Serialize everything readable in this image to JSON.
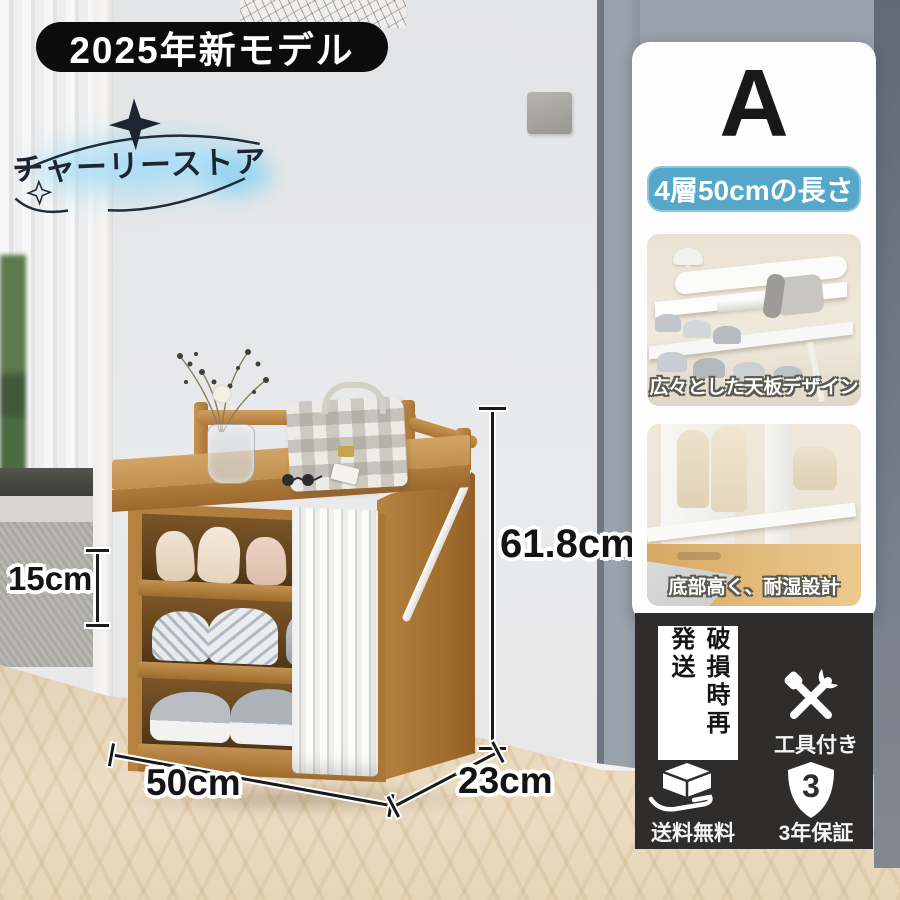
{
  "page": {
    "title_badge": "2025年新モデル",
    "store_name": "チャーリーストア"
  },
  "product": {
    "variant": "A",
    "spec_badge": "4層50cmの長さ"
  },
  "dimensions": {
    "tier_height": "15cm",
    "total_height": "61.8cm",
    "width": "50cm",
    "depth": "23cm"
  },
  "features": [
    {
      "caption": "広々とした天板デザイン"
    },
    {
      "caption": "底部高く、耐湿設計"
    }
  ],
  "services": {
    "reship": "破損時再発送",
    "tools": "工具付き",
    "free_shipping": "送料無料",
    "warranty": "3年保証",
    "warranty_number": "3"
  },
  "colors": {
    "accent_blue": "#55a8c9",
    "badge_black": "#0c0c0c",
    "service_panel_black": "#2e2d2c",
    "bamboo": "#b5823f"
  }
}
